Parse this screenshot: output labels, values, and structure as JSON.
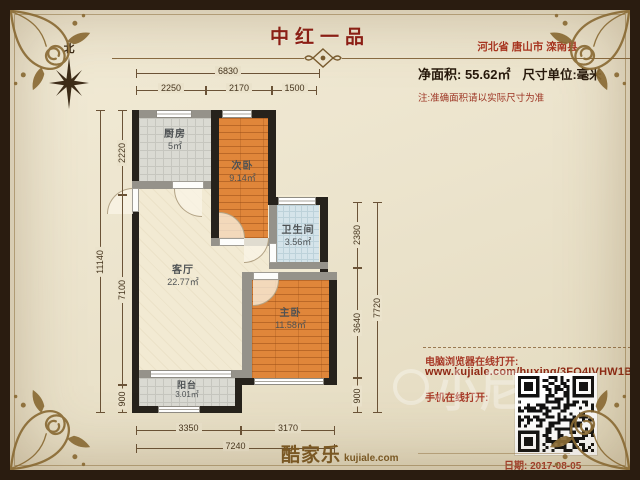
{
  "header": {
    "title": "中红一品",
    "location": "河北省 唐山市 滦南县",
    "area_label": "净面积: 55.62㎡",
    "unit_label": "尺寸单位:毫米",
    "note": "注:准确面积请以实际尺寸为准",
    "compass_label": "北"
  },
  "rooms": [
    {
      "name": "厨房",
      "area": "5㎡"
    },
    {
      "name": "次卧",
      "area": "9.14㎡"
    },
    {
      "name": "卫生间",
      "area": "3.56㎡"
    },
    {
      "name": "客厅",
      "area": "22.77㎡"
    },
    {
      "name": "主卧",
      "area": "11.58㎡"
    },
    {
      "name": "阳台",
      "area": "3.01㎡"
    }
  ],
  "dimensions": {
    "top_total": "6830",
    "top_segments": [
      "2250",
      "2170",
      "1500"
    ],
    "left_total": "11140",
    "left_segments": [
      "2220",
      "7100",
      "900"
    ],
    "right_total": "7720",
    "right_segments": [
      "2380",
      "3640",
      "900"
    ],
    "bottom_total": "7240",
    "bottom_segments": [
      "3350",
      "3170"
    ]
  },
  "footer": {
    "pc_open_label": "电脑浏览器在线打开:",
    "url": "www.kujiale.com/huxing/3FO4IVHW1BAG",
    "mobile_open_label": "手机在线打开:",
    "date_label": "日期: 2017-08-05",
    "logo_text": "酷家乐",
    "logo_domain": "kujiale.com",
    "watermark": "小尼"
  },
  "colors": {
    "accent_red": "#8e1c14",
    "parchment": "#ece4cd",
    "frame_brown": "#2a1c10",
    "gold_ornament": "#8a6b35",
    "wall_dark": "#26221c",
    "wall_light": "#95928a",
    "wood_floor": "#e0863a",
    "gray_tile": "#dadad3",
    "bath_tile": "#d5e4ea"
  }
}
